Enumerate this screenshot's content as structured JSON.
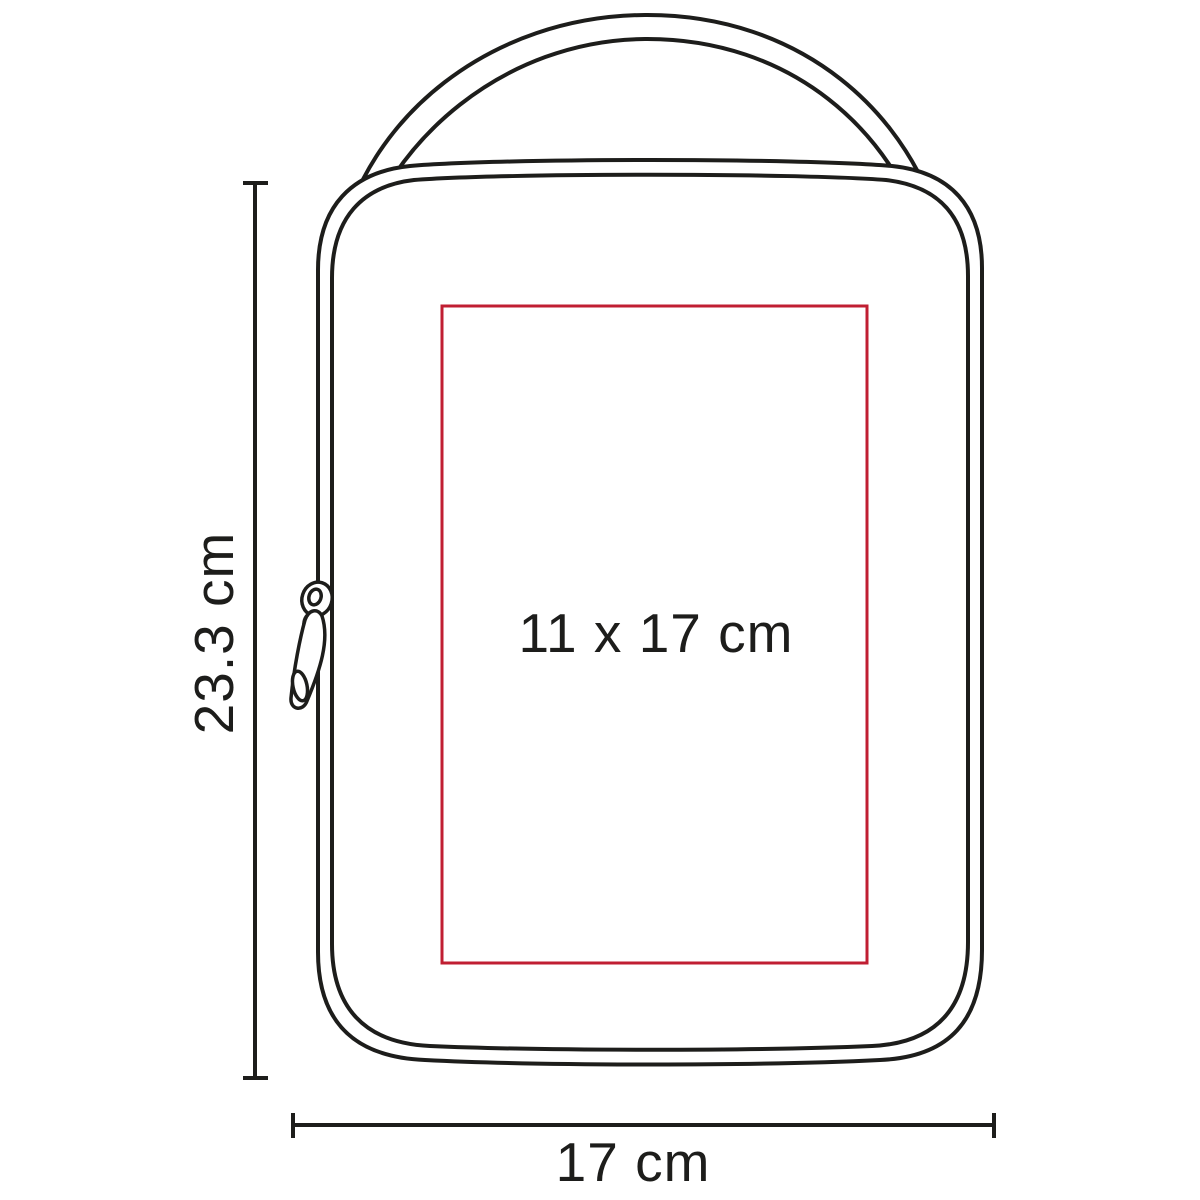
{
  "diagram": {
    "height_dimension": "23.3 cm",
    "width_dimension": "17 cm",
    "print_area_dimension": "11 x 17 cm"
  },
  "figure": {
    "type": "line-drawing",
    "subject": "zippered pouch bag with carry handle",
    "parts": [
      "handle",
      "bag-body",
      "zipper-pull",
      "print-area"
    ]
  },
  "colors": {
    "line": "#1d1d1b",
    "print_area": "#c01e32",
    "background": "#ffffff"
  }
}
